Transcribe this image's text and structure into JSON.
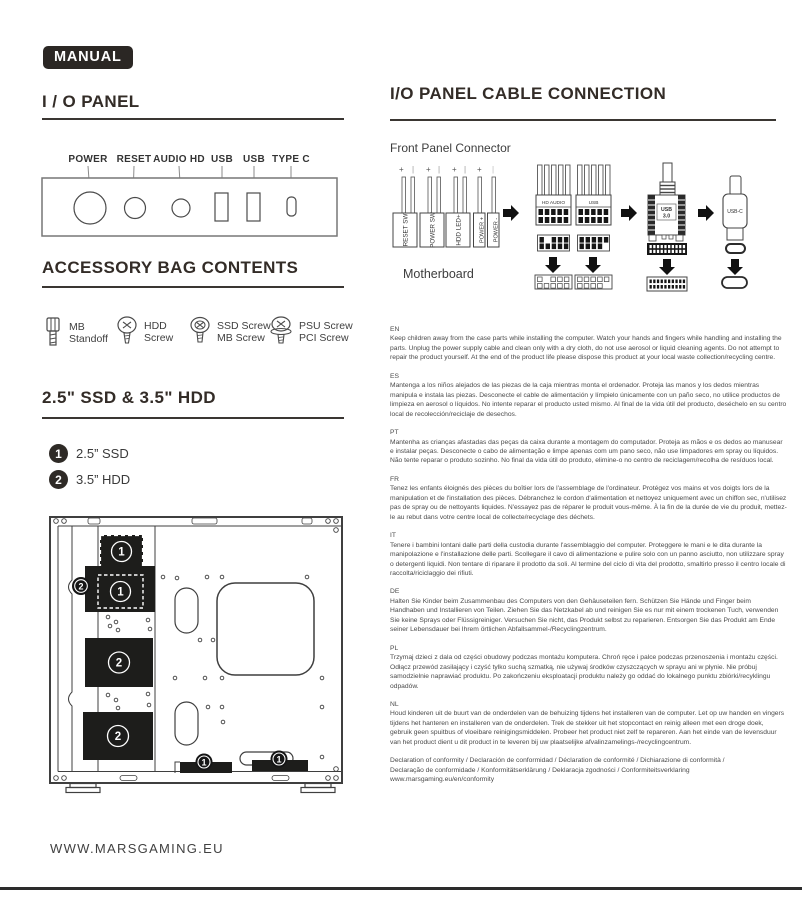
{
  "page": {
    "badge": "MANUAL",
    "website": "WWW.MARSGAMING.EU"
  },
  "io_panel": {
    "title": "I / O PANEL",
    "labels": [
      "POWER",
      "RESET",
      "AUDIO HD",
      "USB",
      "USB",
      "TYPE C"
    ]
  },
  "accessory": {
    "title": "ACCESSORY BAG CONTENTS",
    "items": [
      {
        "line1": "MB",
        "line2": "Standoff"
      },
      {
        "line1": "HDD",
        "line2": "Screw"
      },
      {
        "line1": "SSD Screw",
        "line2": "MB Screw"
      },
      {
        "line1": "PSU Screw",
        "line2": "PCI Screw"
      }
    ]
  },
  "storage": {
    "title": "2.5\" SSD & 3.5\" HDD",
    "legend": [
      {
        "num": "1",
        "label": "2.5” SSD"
      },
      {
        "num": "2",
        "label": "3.5” HDD"
      }
    ]
  },
  "cable": {
    "title": "I/O PANEL CABLE CONNECTION",
    "subtitle": "Front Panel Connector",
    "motherboard": "Motherboard",
    "plus": "+",
    "bar": "|",
    "connectors": [
      "RESET SW",
      "POWER SW",
      "HDD LED+",
      "POWER +",
      "POWER -"
    ],
    "hd_audio": "HD AUDIO",
    "usb": "USB",
    "usb3_l1": "USB",
    "usb3_l2": "3.0",
    "usbc": "USB-C"
  },
  "paragraphs": [
    {
      "lang": "EN",
      "text": "Keep children away from the case parts while installing the computer. Watch your hands and fingers while handling and installing the parts. Unplug the power supply cable and clean only with a dry cloth, do not use aerosol or liquid cleaning agents. Do not attempt to repair the product yourself. At the end of the product life please dispose this product at your local waste collection/recycling centre."
    },
    {
      "lang": "ES",
      "text": "Mantenga a los niños alejados de las piezas de la caja mientras monta el ordenador. Proteja las manos y los dedos mientras manipula e instala las piezas. Desconecte el cable de alimentación y límpielo únicamente con un paño seco, no utilice productos de limpieza en aerosol o líquidos. No intente reparar el producto usted mismo. Al final de la vida útil del producto, deséchelo en su centro local de recolección/reciclaje de desechos."
    },
    {
      "lang": "PT",
      "text": "Mantenha as crianças afastadas das peças da caixa durante a montagem do computador. Proteja as mãos e os dedos ao manusear e instalar peças. Desconecte o cabo de alimentação e limpe apenas com um pano seco, não use limpadores em spray ou líquidos. Não tente reparar o produto sozinho. No final da vida útil do produto, elimine-o no centro de reciclagem/recolha de resíduos local."
    },
    {
      "lang": "FR",
      "text": "Tenez les enfants éloignés des pièces du boîtier lors de l'assemblage de l'ordinateur. Protégez vos mains et vos doigts lors de la manipulation et de l'installation des pièces. Débranchez le cordon d'alimentation et nettoyez uniquement avec un chiffon sec, n'utilisez pas de spray ou de nettoyants liquides. N'essayez pas de réparer le produit vous-même. À la fin de la durée de vie du produit, mettez-le au rebut dans votre centre local de collecte/recyclage des déchets."
    },
    {
      "lang": "IT",
      "text": "Tenere i bambini lontani dalle parti della custodia durante l'assemblaggio del computer. Proteggere le mani e le dita durante la manipolazione e l'installazione delle parti. Scollegare il cavo di alimentazione e pulire solo con un panno asciutto, non utilizzare spray o detergenti liquidi. Non tentare di riparare il prodotto da soli. Al termine del ciclo di vita del prodotto, smaltirlo presso il centro locale di raccolta/riciclaggio dei rifiuti."
    },
    {
      "lang": "DE",
      "text": "Halten Sie Kinder beim Zusammenbau des Computers von den Gehäuseteilen fern. Schützen Sie Hände und Finger beim Handhaben und Installieren von Teilen. Ziehen Sie das Netzkabel ab und reinigen Sie es nur mit einem trockenen Tuch, verwenden Sie keine Sprays oder Flüssigreiniger. Versuchen Sie nicht, das Produkt selbst zu reparieren. Entsorgen Sie das Produkt am Ende seiner Lebensdauer bei Ihrem örtlichen Abfallsammel-/Recyclingzentrum."
    },
    {
      "lang": "PL",
      "text": "Trzymaj dzieci z dala od części obudowy podczas montażu komputera. Chroń ręce i palce podczas przenoszenia i montażu części. Odłącz przewód zasilający i czyść tylko suchą szmatką, nie używaj środków czyszczących w sprayu ani w płynie. Nie próbuj samodzielnie naprawiać produktu. Po zakończeniu eksploatacji produktu należy go oddać do lokalnego punktu zbiórki/recyklingu odpadów."
    },
    {
      "lang": "NL",
      "text": "Houd kinderen uit de buurt van de onderdelen van de behuizing tijdens het installeren van de computer. Let op uw handen en vingers tijdens het hanteren en installeren van de onderdelen. Trek de stekker uit het stopcontact en reinig alleen met een droge doek, gebruik geen spuitbus of vloeibare reinigingsmiddelen. Probeer het product niet zelf te repareren. Aan het einde van de levensduur van het product dient u dit product in te leveren bij uw plaatselijke afvalinzamelings-/recyclingcentrum."
    }
  ],
  "declaration": {
    "line1": "Declaration of conformity / Declaración de conformidad / Déclaration de conformité / Dichiarazione di conformità /",
    "line2": "Declaração de conformidade / Konformitätserklärung / Deklaracja zgodności / Conformiteitsverklaring",
    "line3": "www.marsgaming.eu/en/conformity"
  },
  "colors": {
    "ink": "#2b2724",
    "diagram_fill": "#1d1d1b"
  }
}
